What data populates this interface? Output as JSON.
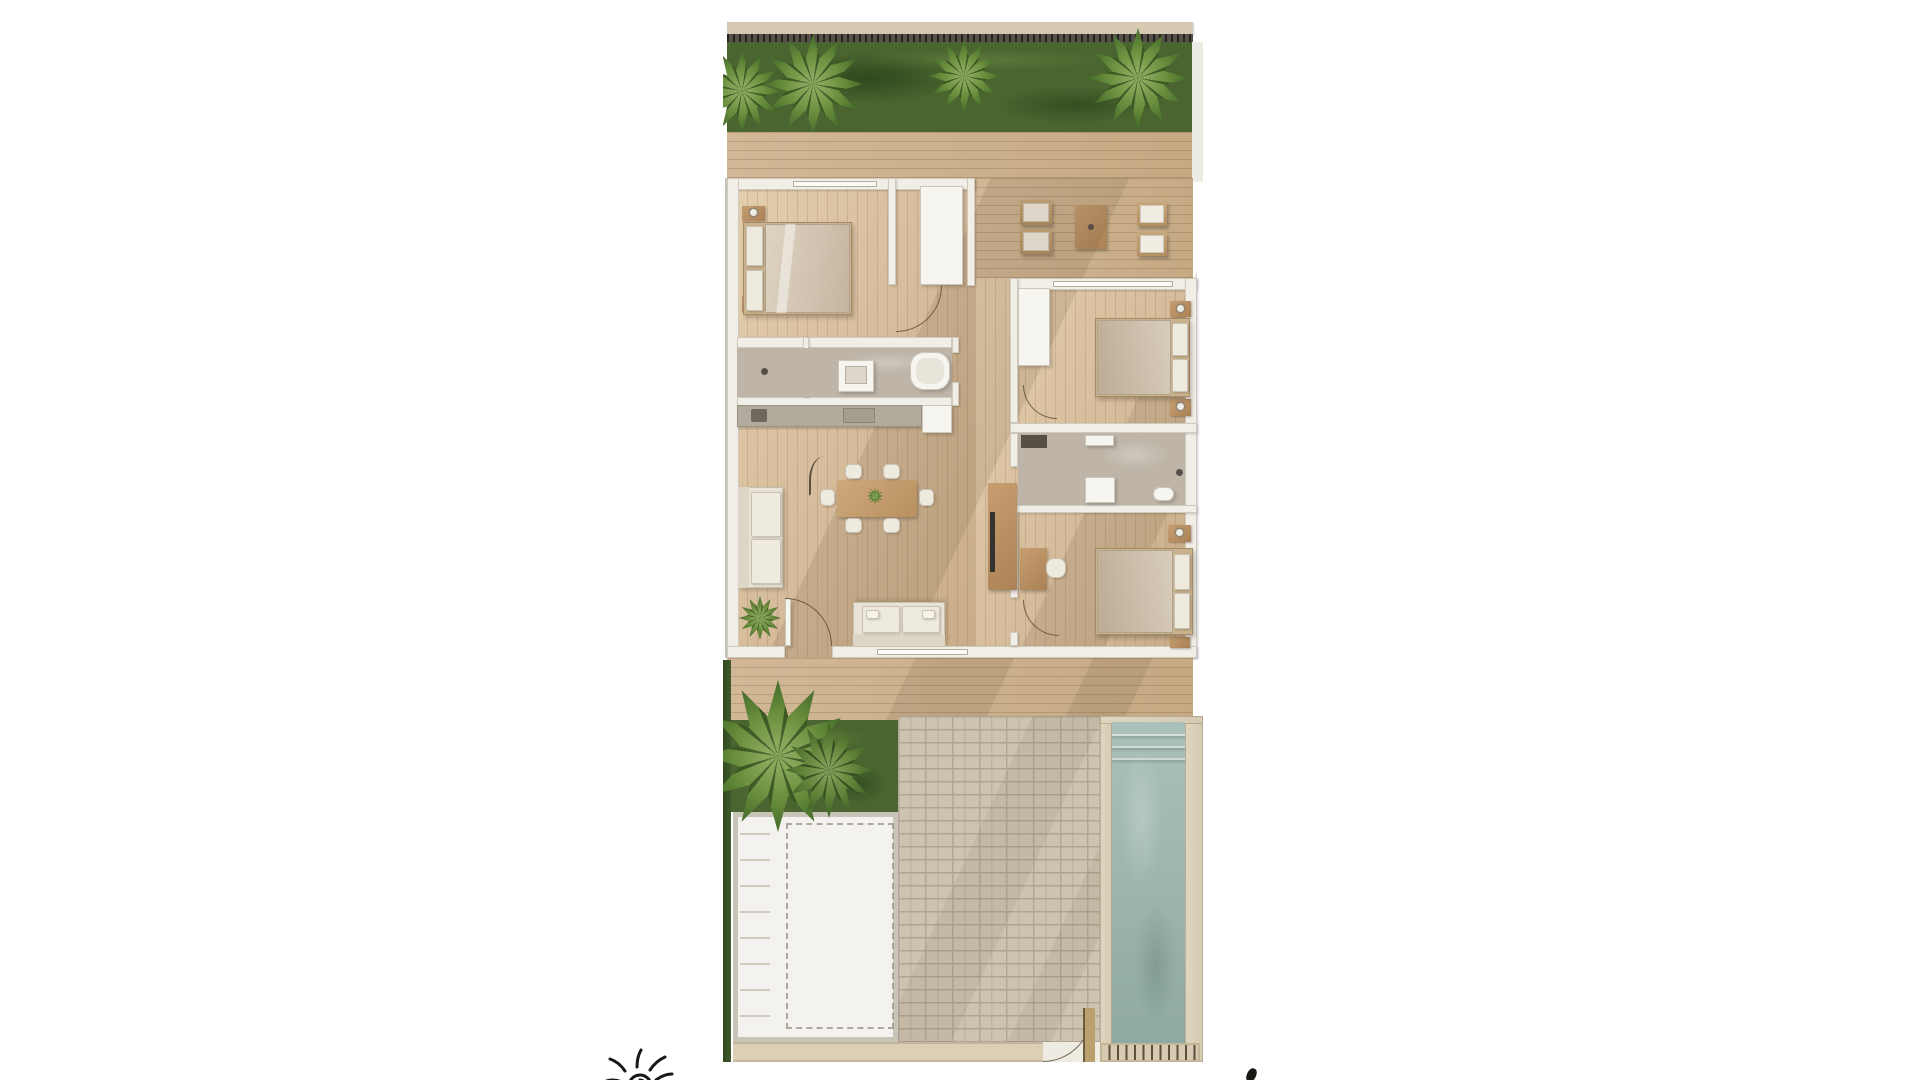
{
  "meta": {
    "description": "Top-down 3D architectural rendering of a three-bedroom villa floor plan, centered on a white page: walled garden with palm trees at top, wooden deck, furnished interior, lower deck, lawn, parking pad, brick driveway, gate and swimming pool at bottom; small hand-drawn sun sketch cropped at the bottom-left edge"
  },
  "colors": {
    "page_bg": "#ffffff",
    "wall_top": "#d7cab3",
    "fence": "#55504a",
    "grass": "#4a652f",
    "palm": "#6a8f3e",
    "palm_light": "#8aa85c",
    "palm_dark": "#49702c",
    "deck": "#c5a983",
    "deck_light": "#d2b896",
    "floor": "#d5bb9a",
    "floor_light": "#e4cfae",
    "wall": "#f1eee7",
    "wall_edge": "#d0cabc",
    "tile": "#beb5a8",
    "counter": "#b2aa9d",
    "wood": "#c69e6f",
    "wood_dark": "#ab8256",
    "brick": "#cdc3b1",
    "brick_line": "#b1a492",
    "pad": "#f3f2ee",
    "pad_frame": "#c9c4b8",
    "sill": "#dccfb5",
    "stone": "#d6cab2",
    "water": "#aac0ba",
    "water_deep": "#8fa9a3",
    "grate_tick": "#5c4f3c",
    "ink": "#191815",
    "shadow": "rgba(92,68,42,0.13)"
  },
  "floorplan": {
    "garden_top": {
      "features": [
        "boundary-wall",
        "hedge-fence",
        "lawn",
        "palm-tree",
        "palm-tree",
        "palm-tree",
        "palm-tree"
      ]
    },
    "deck_top": {
      "features": [
        "wooden-deck"
      ]
    },
    "patio": {
      "furniture": [
        "lounge-chair",
        "lounge-chair",
        "coffee-table",
        "lounge-chair",
        "lounge-chair"
      ]
    },
    "rooms": [
      {
        "id": "bedroom-1",
        "furniture": [
          "double-bed",
          "nightstand",
          "nightstand",
          "walk-in-closet",
          "sliding-window"
        ]
      },
      {
        "id": "bathroom-1",
        "furniture": [
          "shower",
          "vanity-sink",
          "bathtub"
        ]
      },
      {
        "id": "kitchen",
        "furniture": [
          "counter",
          "sink",
          "cooktop",
          "tall-cabinet"
        ]
      },
      {
        "id": "living-dining",
        "furniture": [
          "l-shaped-sofa",
          "loveseat",
          "dining-table",
          "dining-chairs-x6",
          "arc-floor-lamp",
          "potted-plant",
          "tv-console",
          "entry-door",
          "window"
        ]
      },
      {
        "id": "bedroom-2",
        "furniture": [
          "double-bed",
          "nightstand",
          "nightstand",
          "closet",
          "sliding-door"
        ]
      },
      {
        "id": "bathroom-2",
        "furniture": [
          "laundry-counter",
          "shelf",
          "shower",
          "sink",
          "toilet"
        ]
      },
      {
        "id": "bedroom-3",
        "furniture": [
          "double-bed",
          "nightstand",
          "nightstand",
          "desk",
          "desk-chair"
        ]
      }
    ],
    "garden_bottom": {
      "features": [
        "wooden-deck",
        "hedge",
        "palm-tree",
        "lawn",
        "parking-pad",
        "side-steps",
        "parking-marking",
        "brick-driveway",
        "threshold-sill",
        "gate",
        "gate-post",
        "swimming-pool",
        "pool-steps",
        "pool-coping",
        "drain-grate"
      ]
    }
  },
  "annotations": {
    "sun_doodle": "hand-drawn sun sketch, ink style, cropped by page bottom edge",
    "ink_mark": "small ink stroke near bottom-right of the plan"
  }
}
